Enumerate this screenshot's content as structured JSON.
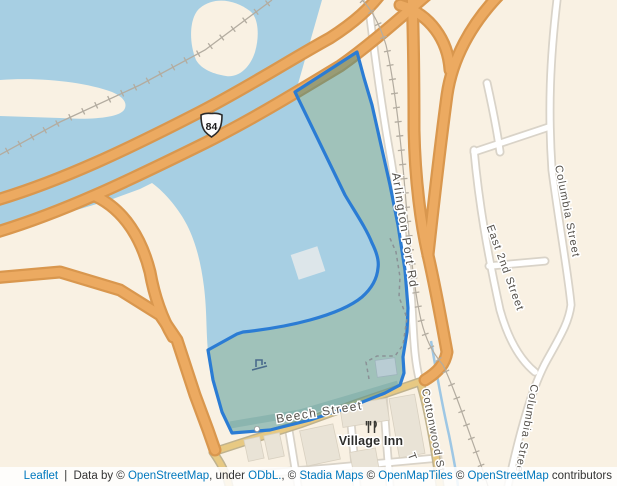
{
  "theme": {
    "water": "#a7cfe3",
    "land": "#f9f1e3",
    "polygon_fill": "rgba(62,142,143,0.48)",
    "polygon_border": "#2b7cd4",
    "highway_fill": "#ecaa61",
    "highway_casing": "#d9974e",
    "secondary_fill": "#e7c983",
    "secondary_casing": "#bfb28e",
    "road_fill": "#ffffff",
    "road_casing": "#d9d3c8",
    "building": "#e9e3d6",
    "link_color": "#0078be"
  },
  "map": {
    "route_shield": "84",
    "streets": {
      "arlington_port_rd": "Arlington Port Rd",
      "columbia_street_upper": "Columbia Street",
      "east_2nd_street": "East 2nd Street",
      "columbia_street_lower": "Columbia Street",
      "beech_street": "Beech Street",
      "cottonwood_st": "Cottonwood St",
      "partial_street": "T"
    },
    "poi": {
      "village_inn": "Village Inn"
    }
  },
  "attribution": {
    "leaflet": "Leaflet",
    "divider": " | ",
    "data_by": "Data by © ",
    "openstreetmap_1": "OpenStreetMap",
    "under": ", under ",
    "odbl": "ODbL.",
    "copy_1": ", © ",
    "stadia_maps": "Stadia Maps",
    "copy_2": " © ",
    "openmaptiles": "OpenMapTiles",
    "copy_3": " © ",
    "openstreetmap_2": "OpenStreetMap",
    "contributors": " contributors"
  }
}
